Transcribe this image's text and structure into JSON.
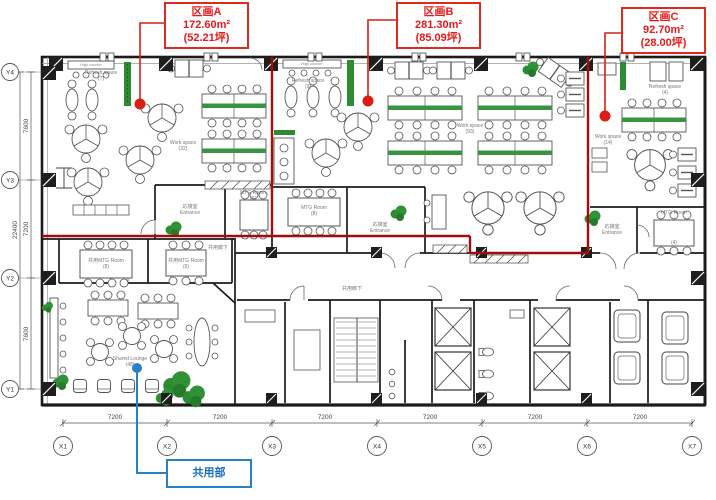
{
  "title": "office floor plan with leased partitions",
  "partitions": [
    {
      "name": "区画A",
      "area": "172.60m²",
      "tsubo": "(52.21坪)"
    },
    {
      "name": "区画B",
      "area": "281.30m²",
      "tsubo": "(85.09坪)"
    },
    {
      "name": "区画C",
      "area": "92.70m²",
      "tsubo": "(28.00坪)"
    }
  ],
  "common_area_label": "共用部",
  "grid": {
    "x_axes": [
      "X1",
      "X2",
      "X3",
      "X4",
      "X5",
      "X6",
      "X7"
    ],
    "y_axes": [
      "Y4",
      "Y3",
      "Y2",
      "Y1"
    ],
    "x_spans": [
      "7200",
      "7200",
      "7200",
      "7200",
      "7200",
      "7200"
    ],
    "y_spans": [
      "7600",
      "7200",
      "7600"
    ],
    "y_total": "22400"
  },
  "zone_a": {
    "high_counter": "High counter",
    "refresh": "Refresh space",
    "refresh_count": "(7)",
    "work": "Work space",
    "work_count": "(32)",
    "reception": "応接室",
    "entrance": "Entrance",
    "mtg": "MTG Room",
    "mtg_count": "(6)"
  },
  "zone_b": {
    "high_counter": "High counter",
    "refresh": "Refresh space",
    "refresh_count": "(9)",
    "work": "Work space",
    "work_count": "(93)",
    "reception": "応接室",
    "entrance": "Entrance",
    "mtg": "MTG Room",
    "mtg_count": "(8)"
  },
  "zone_c": {
    "refresh": "Refresh space",
    "refresh_count": "(4)",
    "work": "Work space",
    "work_count": "(14)",
    "reception": "応接室",
    "entrance": "Entrance",
    "mtg": "MTG Room",
    "mtg_count": "(4)"
  },
  "common": {
    "mtg1": "共用MTG Room",
    "mtg1_count": "(8)",
    "mtg2": "共用MTG Room",
    "mtg2_count": "(6)",
    "corridor1": "共用廊下",
    "corridor2": "共用廊下",
    "lounge": "Shared Lounge",
    "lounge_count": "(48)"
  },
  "colors": {
    "partition_red": "#d81e17",
    "boundary_red": "#a50d0d",
    "common_blue": "#2a7fc9",
    "plant_green": "#2e8b32",
    "desk_green": "#3a9340"
  }
}
